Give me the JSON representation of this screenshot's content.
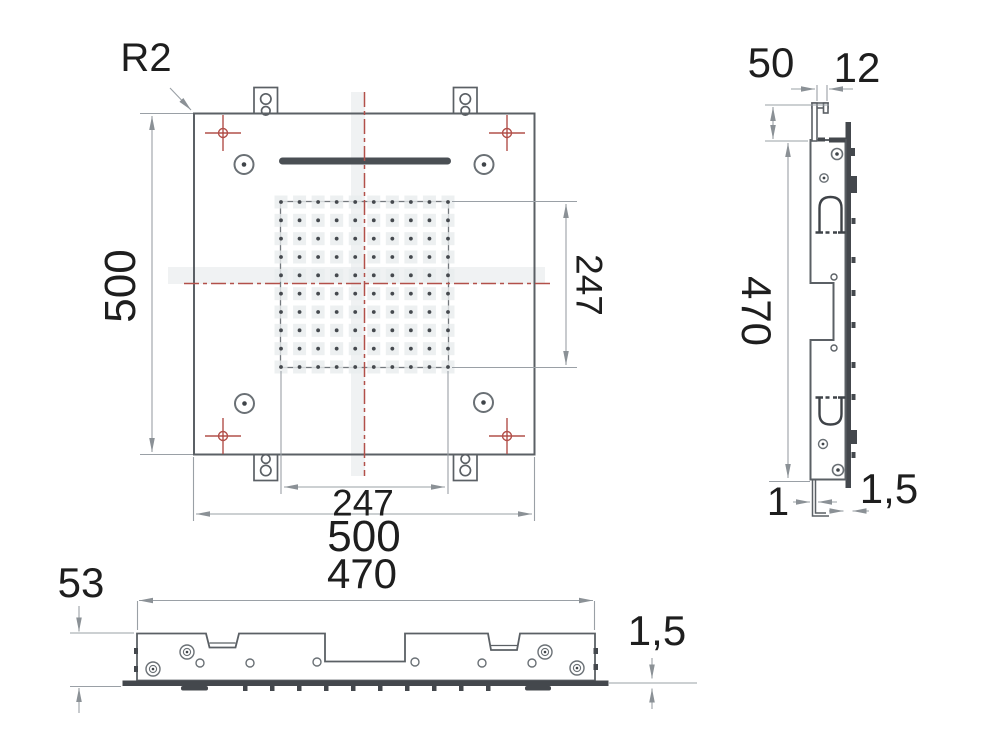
{
  "drawing_labels": {
    "plan": {
      "corner_radius": "R2",
      "side_length_vertical": "500",
      "side_length_horizontal": "500",
      "nozzle_field_height": "247",
      "nozzle_field_width": "247"
    },
    "side": {
      "bracket_height": "50",
      "bracket_offset": "12",
      "body_height": "470",
      "flange_thickness": "1",
      "panel_thickness": "1,5"
    },
    "front": {
      "body_height": "53",
      "body_width": "470",
      "panel_thickness": "1,5"
    },
    "nozzle_grid": {
      "rows": 10,
      "cols": 10
    },
    "colors": {
      "outline": "#5b6065",
      "dimension_line": "#9aa0a6",
      "centerline_red": "#b2504a",
      "dark_fill": "#44484d",
      "label_text": "#1e1e1e"
    }
  }
}
